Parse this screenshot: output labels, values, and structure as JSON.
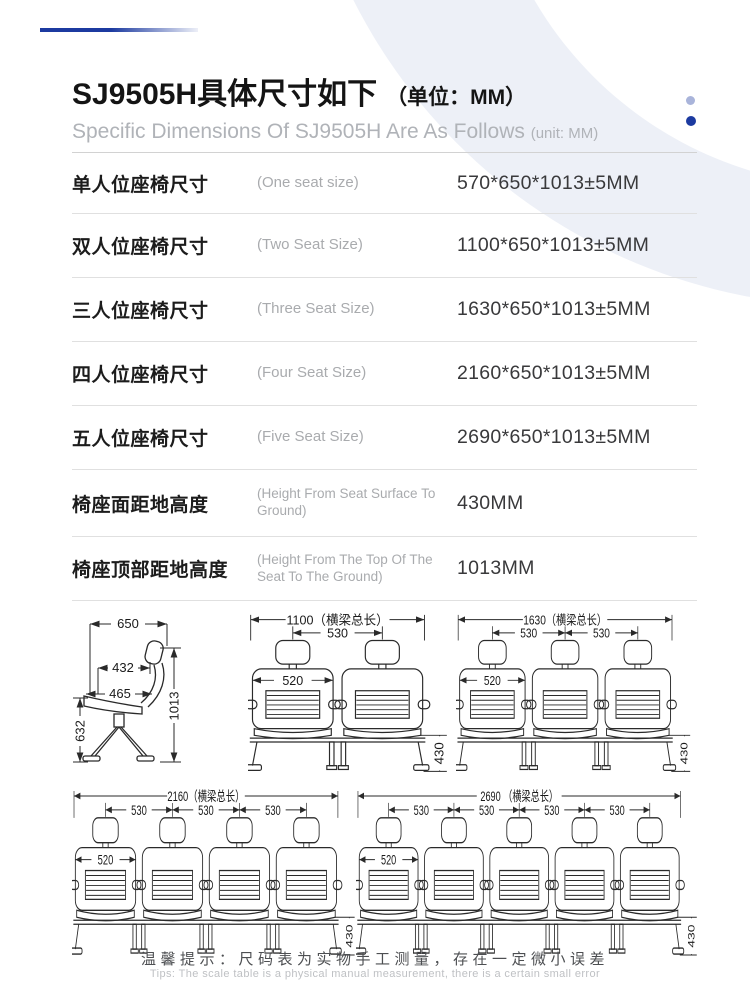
{
  "colors": {
    "accent_dark": "#1c3aa0",
    "accent_light": "#a9b4da",
    "arc_background": "#edf0f7",
    "drawing_line": "#2a2a2a"
  },
  "header": {
    "title_zh": "SJ9505H具体尺寸如下",
    "title_unit": "（单位：MM）",
    "subtitle_en": "Specific Dimensions Of SJ9505H Are As Follows",
    "subtitle_unit": "(unit: MM)"
  },
  "spec_table": {
    "rows": [
      {
        "label_zh": "单人位座椅尺寸",
        "label_en": "(One seat size)",
        "value": "570*650*1013±5MM"
      },
      {
        "label_zh": "双人位座椅尺寸",
        "label_en": "(Two Seat Size)",
        "value": "1100*650*1013±5MM"
      },
      {
        "label_zh": "三人位座椅尺寸",
        "label_en": "(Three Seat Size)",
        "value": "1630*650*1013±5MM"
      },
      {
        "label_zh": "四人位座椅尺寸",
        "label_en": "(Four Seat Size)",
        "value": "2160*650*1013±5MM"
      },
      {
        "label_zh": "五人位座椅尺寸",
        "label_en": "(Five Seat Size)",
        "value": "2690*650*1013±5MM"
      },
      {
        "label_zh": "椅座面距地高度",
        "label_en": "(Height From Seat Surface To Ground)",
        "value": "430MM"
      },
      {
        "label_zh": "椅座顶部距地高度",
        "label_en": "(Height From The Top Of The Seat To The Ground)",
        "value": "1013MM"
      }
    ]
  },
  "drawings": {
    "side_view": {
      "depth": "650",
      "seat_depth": "432",
      "seat_width": "465",
      "total_height": "1013",
      "back_height": "632"
    },
    "front_views": [
      {
        "name": "two-seat",
        "beam": "1100（横梁总长）",
        "pitch": "530",
        "back_width": "520",
        "seat_height": "430"
      },
      {
        "name": "three-seat",
        "beam": "1630（横梁总长）",
        "pitch": "530",
        "back_width": "520",
        "seat_height": "430"
      },
      {
        "name": "four-seat",
        "beam": "2160（横梁总长）",
        "pitch": "530",
        "back_width": "520",
        "seat_height": "430"
      },
      {
        "name": "five-seat",
        "beam": "2690 （横梁总长）",
        "pitch": "530",
        "back_width": "520",
        "seat_height": "430"
      }
    ]
  },
  "footer": {
    "tip_zh": "温馨提示：尺码表为实物手工测量，存在一定微小误差",
    "tip_en": "Tips: The scale table is a physical manual measurement, there is a certain small error"
  }
}
